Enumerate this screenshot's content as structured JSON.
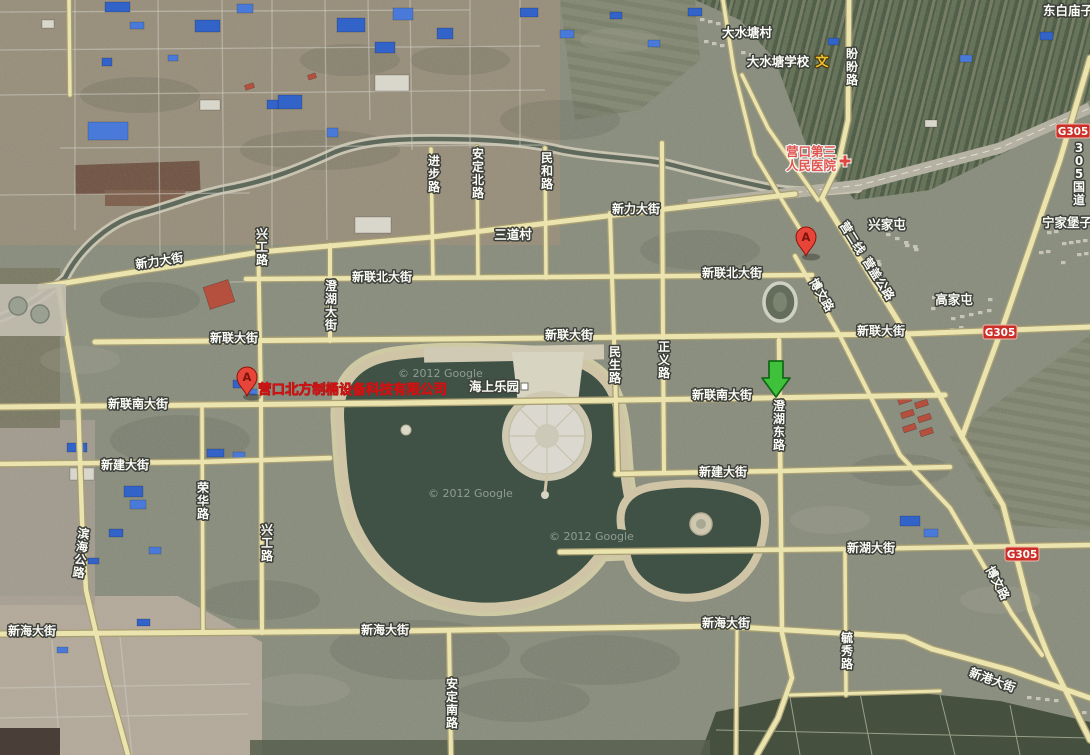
{
  "map": {
    "size": {
      "w": 1090,
      "h": 755
    },
    "watermark_text": "© 2012 Google",
    "watermarks": [
      {
        "x": 398,
        "y": 377
      },
      {
        "x": 428,
        "y": 497
      },
      {
        "x": 549,
        "y": 540
      }
    ],
    "roads": [
      {
        "name": "新力大街",
        "w": 5.0,
        "pts": [
          [
            40,
            287
          ],
          [
            260,
            252
          ],
          [
            432,
            237
          ],
          [
            640,
            212
          ],
          [
            795,
            194
          ]
        ]
      },
      {
        "name": "新联北大街",
        "w": 4.5,
        "pts": [
          [
            246,
            279
          ],
          [
            560,
            277
          ],
          [
            812,
            275
          ]
        ]
      },
      {
        "name": "新联大街",
        "w": 5.0,
        "pts": [
          [
            95,
            342
          ],
          [
            550,
            338
          ],
          [
            905,
            334
          ],
          [
            1090,
            327
          ]
        ]
      },
      {
        "name": "新联南大街",
        "w": 5.0,
        "pts": [
          [
            0,
            407
          ],
          [
            400,
            403
          ],
          [
            700,
            399
          ],
          [
            945,
            395
          ]
        ]
      },
      {
        "name": "新建大街",
        "w": 4.5,
        "pts": [
          [
            0,
            464
          ],
          [
            200,
            462
          ],
          [
            330,
            458
          ]
        ]
      },
      {
        "name": "新建大街",
        "w": 4.5,
        "pts": [
          [
            616,
            474
          ],
          [
            780,
            471
          ],
          [
            950,
            467
          ]
        ]
      },
      {
        "name": "新湖大街",
        "w": 4.5,
        "pts": [
          [
            560,
            552
          ],
          [
            850,
            549
          ],
          [
            1090,
            545
          ]
        ]
      },
      {
        "name": "新海大街",
        "w": 5.0,
        "pts": [
          [
            0,
            634
          ],
          [
            400,
            631
          ],
          [
            720,
            626
          ],
          [
            905,
            637
          ],
          [
            932,
            649
          ]
        ]
      },
      {
        "name": "新港大街",
        "w": 5.0,
        "pts": [
          [
            932,
            649
          ],
          [
            1010,
            670
          ],
          [
            1090,
            698
          ]
        ]
      },
      {
        "name": "滨海公路",
        "w": 4.5,
        "pts": [
          [
            58,
            284
          ],
          [
            78,
            400
          ],
          [
            82,
            520
          ],
          [
            86,
            590
          ],
          [
            106,
            676
          ],
          [
            128,
            755
          ]
        ]
      },
      {
        "name": "兴工路",
        "w": 4.0,
        "pts": [
          [
            258,
            232
          ],
          [
            261,
            404
          ],
          [
            262,
            633
          ]
        ]
      },
      {
        "name": "荣华路",
        "w": 3.5,
        "pts": [
          [
            202,
            406
          ],
          [
            203,
            633
          ]
        ]
      },
      {
        "name": "澄湖大街",
        "w": 4.0,
        "pts": [
          [
            330,
            245
          ],
          [
            330,
            341
          ]
        ]
      },
      {
        "name": "进步路",
        "w": 3.5,
        "pts": [
          [
            431,
            149
          ],
          [
            433,
            278
          ]
        ]
      },
      {
        "name": "安定北路",
        "w": 3.5,
        "pts": [
          [
            477,
            147
          ],
          [
            478,
            278
          ]
        ]
      },
      {
        "name": "民和路",
        "w": 3.5,
        "pts": [
          [
            545,
            148
          ],
          [
            546,
            278
          ]
        ]
      },
      {
        "name": "民生路",
        "w": 4.0,
        "pts": [
          [
            610,
            213
          ],
          [
            614,
            340
          ],
          [
            618,
            472
          ]
        ]
      },
      {
        "name": "正义路",
        "w": 4.0,
        "pts": [
          [
            662,
            143
          ],
          [
            663,
            341
          ],
          [
            664,
            472
          ]
        ]
      },
      {
        "name": "澄湖东路",
        "w": 4.5,
        "pts": [
          [
            779,
            340
          ],
          [
            782,
            633
          ],
          [
            792,
            678
          ],
          [
            778,
            718
          ],
          [
            757,
            755
          ]
        ]
      },
      {
        "name": "毓秀路",
        "w": 3.5,
        "pts": [
          [
            845,
            552
          ],
          [
            846,
            695
          ]
        ]
      },
      {
        "name": "盼盼路",
        "w": 4.5,
        "pts": [
          [
            849,
            0
          ],
          [
            848,
            120
          ],
          [
            838,
            165
          ],
          [
            822,
            198
          ]
        ]
      },
      {
        "name": "营盖公路",
        "w": 5.0,
        "pts": [
          [
            822,
            198
          ],
          [
            908,
            337
          ],
          [
            962,
            437
          ],
          [
            1003,
            505
          ],
          [
            1030,
            610
          ],
          [
            1048,
            655
          ],
          [
            1090,
            740
          ]
        ]
      },
      {
        "name": "博文路",
        "w": 4.0,
        "pts": [
          [
            795,
            256
          ],
          [
            838,
            332
          ],
          [
            900,
            455
          ],
          [
            950,
            508
          ],
          [
            1012,
            614
          ],
          [
            1042,
            655
          ]
        ]
      },
      {
        "name": "305国道",
        "w": 5.0,
        "pts": [
          [
            1090,
            58
          ],
          [
            1060,
            160
          ],
          [
            1005,
            320
          ],
          [
            962,
            437
          ]
        ]
      },
      {
        "name": "村道",
        "w": 3.5,
        "pts": [
          [
            723,
            0
          ],
          [
            734,
            70
          ],
          [
            755,
            155
          ],
          [
            785,
            205
          ],
          [
            808,
            242
          ]
        ]
      },
      {
        "name": "安定南路",
        "w": 4.0,
        "pts": [
          [
            449,
            633
          ],
          [
            451,
            755
          ]
        ]
      },
      {
        "name": "支路",
        "w": 3.0,
        "pts": [
          [
            737,
            628
          ],
          [
            736,
            755
          ]
        ]
      },
      {
        "name": "支路",
        "w": 3.0,
        "pts": [
          [
            790,
            695
          ],
          [
            940,
            691
          ]
        ]
      },
      {
        "name": "支路",
        "w": 3.5,
        "pts": [
          [
            69,
            0
          ],
          [
            70,
            95
          ]
        ]
      },
      {
        "name": "支路",
        "w": 3.5,
        "pts": [
          [
            742,
            75
          ],
          [
            768,
            128
          ],
          [
            818,
            200
          ]
        ]
      }
    ],
    "road_labels": [
      {
        "text": "新力大街",
        "x": 160,
        "y": 265,
        "o": "h",
        "r": -9
      },
      {
        "text": "新力大街",
        "x": 636,
        "y": 213,
        "o": "h",
        "r": 0
      },
      {
        "text": "新联北大街",
        "x": 382,
        "y": 281,
        "o": "h",
        "r": 0
      },
      {
        "text": "新联北大街",
        "x": 732,
        "y": 277,
        "o": "h",
        "r": 0
      },
      {
        "text": "新联大街",
        "x": 234,
        "y": 342,
        "o": "h",
        "r": 0
      },
      {
        "text": "新联大街",
        "x": 569,
        "y": 339,
        "o": "h",
        "r": 0
      },
      {
        "text": "新联大街",
        "x": 881,
        "y": 335,
        "o": "h",
        "r": 0
      },
      {
        "text": "新联南大街",
        "x": 138,
        "y": 408,
        "o": "h",
        "r": 0
      },
      {
        "text": "新联南大街",
        "x": 722,
        "y": 399,
        "o": "h",
        "r": 0
      },
      {
        "text": "新建大街",
        "x": 125,
        "y": 469,
        "o": "h",
        "r": 0
      },
      {
        "text": "新建大街",
        "x": 723,
        "y": 476,
        "o": "h",
        "r": 0
      },
      {
        "text": "新湖大街",
        "x": 871,
        "y": 552,
        "o": "h",
        "r": 0
      },
      {
        "text": "新海大街",
        "x": 32,
        "y": 635,
        "o": "h",
        "r": 0
      },
      {
        "text": "新海大街",
        "x": 385,
        "y": 634,
        "o": "h",
        "r": 0
      },
      {
        "text": "新海大街",
        "x": 726,
        "y": 627,
        "o": "h",
        "r": 0
      },
      {
        "text": "新港大街",
        "x": 991,
        "y": 684,
        "o": "h",
        "r": 20
      },
      {
        "text": "盼盼路",
        "x": 852,
        "y": 58,
        "o": "v",
        "r": 0
      },
      {
        "text": "进步路",
        "x": 434,
        "y": 165,
        "o": "v",
        "r": 0
      },
      {
        "text": "安定北路",
        "x": 478,
        "y": 158,
        "o": "v",
        "r": 0
      },
      {
        "text": "民和路",
        "x": 547,
        "y": 162,
        "o": "v",
        "r": 0
      },
      {
        "text": "兴工路",
        "x": 262,
        "y": 238,
        "o": "v",
        "r": 0
      },
      {
        "text": "澄湖大街",
        "x": 331,
        "y": 290,
        "o": "v",
        "r": 0
      },
      {
        "text": "民生路",
        "x": 615,
        "y": 356,
        "o": "v",
        "r": 0
      },
      {
        "text": "正义路",
        "x": 664,
        "y": 351,
        "o": "v",
        "r": 0
      },
      {
        "text": "澄湖东路",
        "x": 779,
        "y": 410,
        "o": "v",
        "r": 0
      },
      {
        "text": "荣华路",
        "x": 203,
        "y": 492,
        "o": "v",
        "r": 0
      },
      {
        "text": "兴工路",
        "x": 267,
        "y": 534,
        "o": "v",
        "r": 0
      },
      {
        "text": "滨海公路",
        "x": 83,
        "y": 538,
        "o": "v",
        "r": 7
      },
      {
        "text": "安定南路",
        "x": 452,
        "y": 688,
        "o": "v",
        "r": 0
      },
      {
        "text": "毓秀路",
        "x": 847,
        "y": 642,
        "o": "v",
        "r": 0
      },
      {
        "text": "营二线",
        "x": 849,
        "y": 240,
        "o": "h",
        "r": 58
      },
      {
        "text": "营盖公路",
        "x": 875,
        "y": 281,
        "o": "h",
        "r": 58
      },
      {
        "text": "博文路",
        "x": 818,
        "y": 297,
        "o": "h",
        "r": 60
      },
      {
        "text": "博文路",
        "x": 994,
        "y": 585,
        "o": "h",
        "r": 62
      },
      {
        "text": "305国道",
        "x": 1079,
        "y": 152,
        "o": "v",
        "r": 0
      }
    ],
    "place_labels": [
      {
        "text": "大水塘村",
        "x": 747,
        "y": 37
      },
      {
        "text": "东白庙子",
        "x": 1068,
        "y": 15
      },
      {
        "text": "兴家屯",
        "x": 887,
        "y": 229
      },
      {
        "text": "宁家堡子",
        "x": 1067,
        "y": 227
      },
      {
        "text": "高家屯",
        "x": 954,
        "y": 304
      },
      {
        "text": "三道村",
        "x": 513,
        "y": 239
      }
    ],
    "pois": {
      "school": {
        "text": "大水塘学校",
        "x": 778,
        "y": 66,
        "icon": "文",
        "icon_x": 822,
        "icon_y": 66,
        "icon_color": "#f2c12e"
      },
      "hospital": {
        "line1": "营口第三",
        "line2": "人民医院",
        "x": 811,
        "y1": 156,
        "y2": 170,
        "cross_x": 845,
        "cross_y": 161,
        "color": "#e25550"
      },
      "park": {
        "text": "海上乐园",
        "x": 494,
        "y": 391,
        "sq_x": 521,
        "sq_y": 383
      },
      "company": {
        "text": "营口北方制桶设备科技有限公司",
        "x": 258,
        "y": 394,
        "color": "#d41212"
      }
    },
    "route_badges": [
      {
        "text": "G305",
        "x": 1073,
        "y": 131
      },
      {
        "text": "G305",
        "x": 1000,
        "y": 332
      },
      {
        "text": "G305",
        "x": 1022,
        "y": 554
      }
    ],
    "markers": [
      {
        "type": "pin",
        "letter": "A",
        "x": 806,
        "y": 237
      },
      {
        "type": "pin",
        "letter": "A",
        "x": 247,
        "y": 377
      },
      {
        "type": "green-arrow",
        "x": 776,
        "y": 397
      }
    ],
    "colors": {
      "road_fill": "#ece4ae",
      "road_casing": "#a89f74",
      "water": "#3f5245",
      "sand": "#cfc5a6",
      "badge_red": "#cb2f27",
      "pin_red": "#e8453a",
      "arrow_green": "#3fc13b"
    }
  }
}
